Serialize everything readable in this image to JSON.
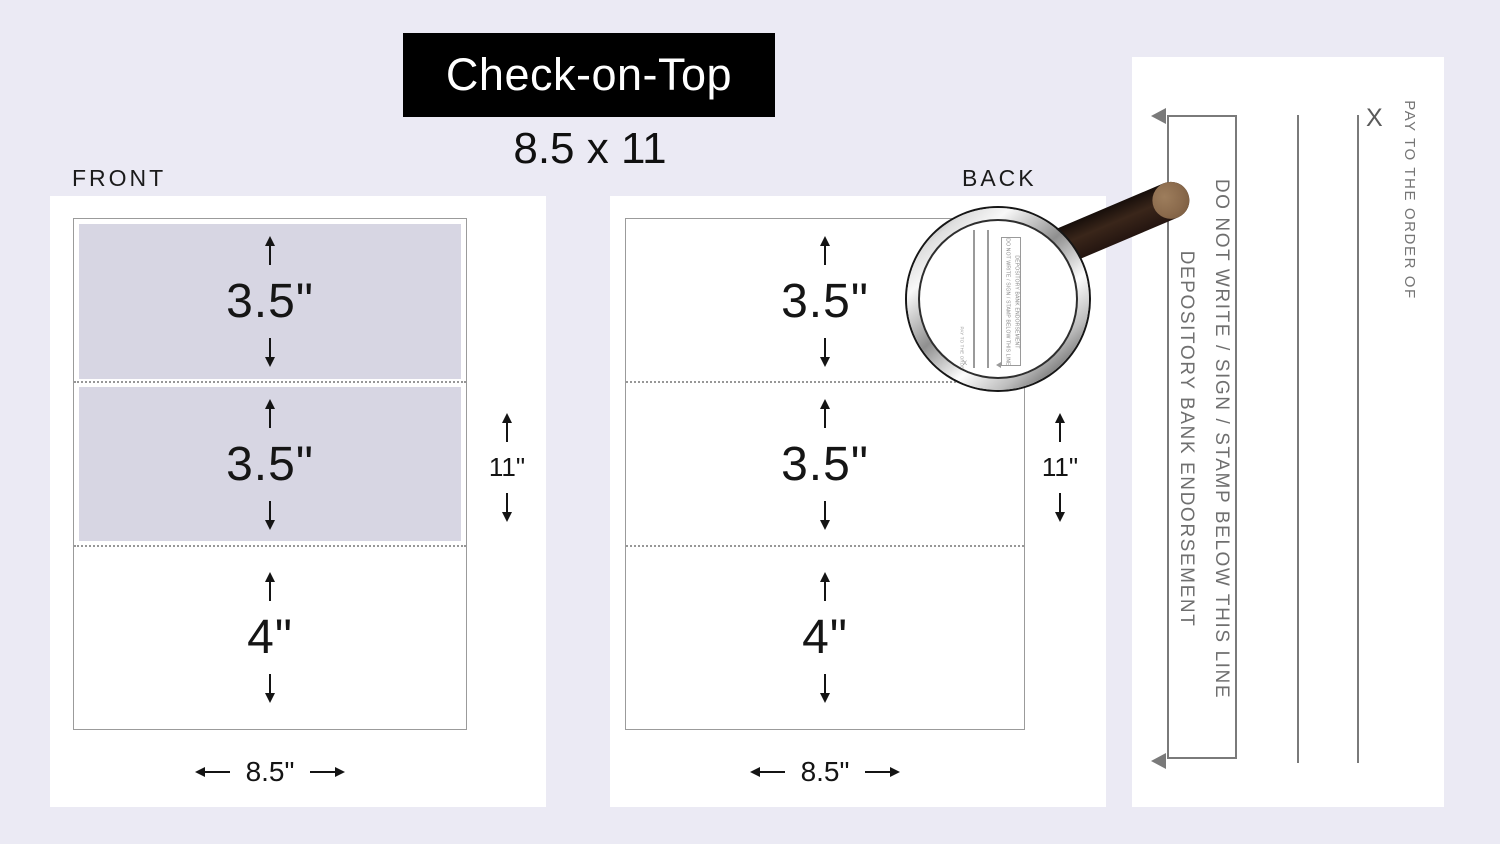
{
  "title": {
    "name": "Check-on-Top",
    "size": "8.5 x 11"
  },
  "front": {
    "label": "FRONT",
    "sections": [
      {
        "label": "3.5\""
      },
      {
        "label": "3.5\""
      },
      {
        "label": "4\""
      }
    ],
    "height_label": "11\"",
    "width_label": "8.5\""
  },
  "back": {
    "label": "BACK",
    "sections": [
      {
        "label": "3.5\""
      },
      {
        "label": "3.5\""
      },
      {
        "label": "4\""
      }
    ],
    "height_label": "11\"",
    "width_label": "8.5\""
  },
  "check_back": {
    "pay_to": "PAY TO THE ORDER OF",
    "signature_mark": "X",
    "do_not_write": "DO NOT WRITE / SIGN / STAMP BELOW THIS LINE",
    "endorsement": "DEPOSITORY BANK ENDORSEMENT"
  },
  "colors": {
    "background": "#ebeaf4",
    "panel": "#ffffff",
    "stub_shade": "#d7d6e3",
    "title_bg": "#000000",
    "title_text": "#ffffff",
    "ink": "#141414",
    "check_gray": "#6f6f6f",
    "handle_brown": "#3a261a",
    "handle_cap": "#8a6a4c"
  }
}
